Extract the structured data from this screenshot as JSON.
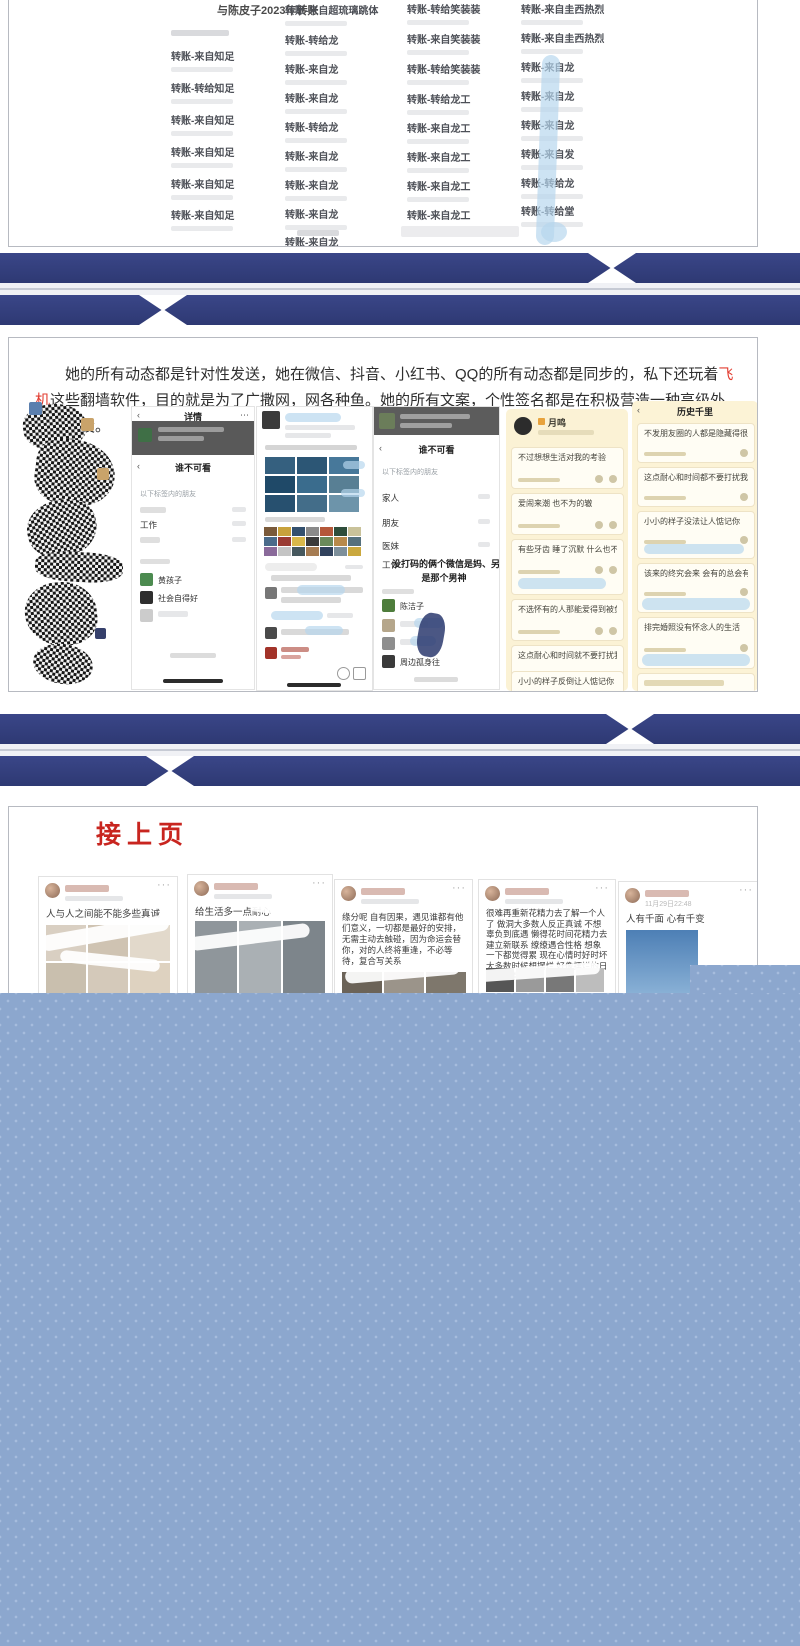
{
  "colors": {
    "navy": "#343f7e",
    "blue_block": "#8ca7ce",
    "red_title": "#c8251f",
    "highlight_red": "#e23c30"
  },
  "panel1": {
    "title": "与陈皮子2023年转账",
    "col1": [
      "转账-来自知足",
      "转账-转给知足",
      "转账-来自知足",
      "转账-来自知足",
      "转账-来自知足",
      "转账-来自知足"
    ],
    "col2": [
      "转账-来自超琉璃跳体",
      "转账-转给龙",
      "转账-来自龙",
      "转账-来自龙",
      "转账-转给龙",
      "转账-来自龙",
      "转账-来自龙",
      "转账-来自龙",
      "转账-来自龙"
    ],
    "col3": [
      "转账-转给笑装装",
      "转账-来自笑装装",
      "转账-转给笑装装",
      "转账-转给龙工",
      "转账-来自龙工",
      "转账-来自龙工",
      "转账-来自龙工",
      "转账-来自龙工"
    ],
    "col4": [
      "转账-来自圭西热烈",
      "转账-来自圭西热烈",
      "转账-来自龙",
      "转账-来自龙",
      "转账-来自龙",
      "转账-来自发",
      "转账-转给龙",
      "转账-转给堂"
    ]
  },
  "panel2": {
    "para": {
      "t1": "她的所有动态都是针对性发送，她在微信、抖音、小红书、QQ的所有动态都是同步的，私下还玩着",
      "hl": "飞机",
      "t2": "这些翻墙软件，目的就是为了广撒网，网各种鱼。她的所有文案，个性签名都是在积极营造一种高级外围女人设。"
    },
    "shot_b": {
      "back": "‹",
      "header": "详情",
      "menu": "⋯",
      "title": "谁不可看",
      "section": "以下标签内的朋友",
      "row2": "工作",
      "contact1": "黄孩子",
      "contact2": "社会自得好"
    },
    "shot_d": {
      "back": "‹",
      "title": "谁不可看",
      "section": "以下标签内的朋友",
      "rows": [
        "家人",
        "朋友",
        "医妹",
        "工作"
      ],
      "note1": "没打码的俩个微信是妈、另外俩个",
      "note2": "是那个男神",
      "contact1": "陈洁子",
      "contact4": "周边孤身往"
    },
    "qq_profile": {
      "name": "月鸣",
      "posts": [
        "不过想想生活对我的考验",
        "爱闹来潮 也不为的辙",
        "有些牙齿 睡了沉默 什么也不想说",
        "不选怀有的人那能爱得到被负",
        "这点耐心和时间就不要打扰我了",
        "小小的样子反倒让人惦记你"
      ]
    },
    "qq_history": {
      "back": "‹",
      "title": "历史千里",
      "posts": [
        "不发朋友圈的人都是隐藏得很深的",
        "这点耐心和时间都不要打扰我了",
        "小小的样子没法让人惦记你",
        "该来的终究会来 会有的总会有的",
        "排完婚照没有怀念人的生活"
      ]
    }
  },
  "panel3": {
    "continue_label": "接上页",
    "dots": "···",
    "cards": [
      {
        "text": "人与人之间能不能多些真诚"
      },
      {
        "text": "给生活多一点耐心"
      },
      {
        "text": "缘分呢 自有因果，遇见谁都有他们意义，一切都是最好的安排，无需主动去触碰，因为命运会替你，对的人终将重逢，不必等待，复合写关系"
      },
      {
        "text": "很难再重新花精力去了解一个人了 做洞大多数人反正真诚 不想辜负到底遇 懒得花时间花精力去建立新联系 缭缭遇合性格 想象一下都觉得累 现在心情时好时坏 大多数时候想摆烂 好像摆烂的日子也没有很坏"
      },
      {
        "text": "人有千面 心有千变",
        "date": "11月29日22:48"
      }
    ]
  }
}
